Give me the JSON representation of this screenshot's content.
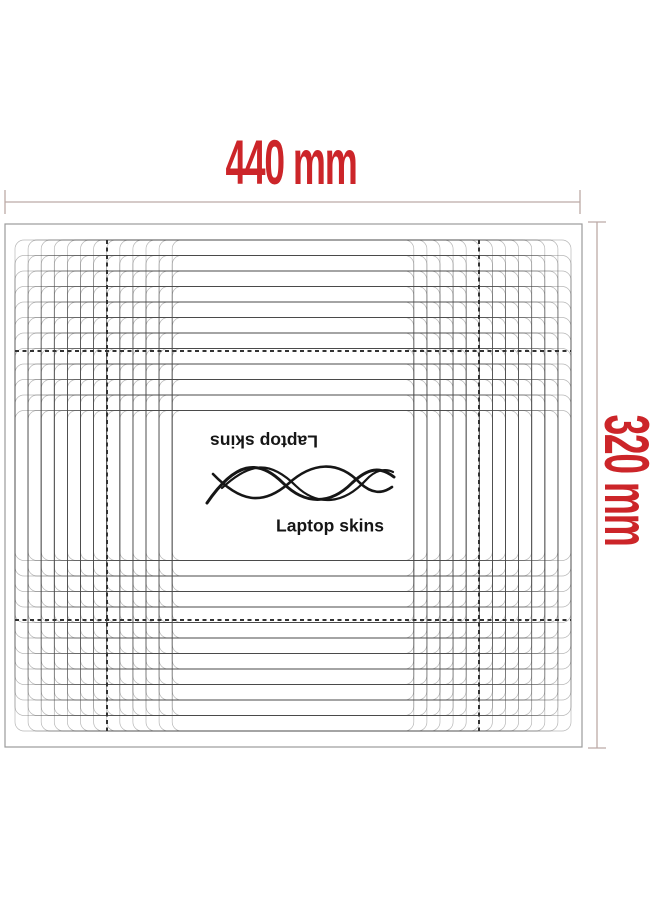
{
  "dimensions": {
    "width_label": "440 mm",
    "height_label": "320 mm"
  },
  "logo": {
    "brand_top_flipped": "Laptop skins",
    "brand_bottom": "Laptop skins"
  },
  "icons": {
    "logo_swirl": "wave-swirl-flourish"
  },
  "colors": {
    "dimension_red": "#cc2529",
    "dim_line": "#bcaaa6",
    "grid_line": "#4a4a4a",
    "dash_line": "#333333",
    "border": "#9b9b9b",
    "logo_ink": "#161616"
  },
  "template": {
    "sheet": {
      "x": 5,
      "y": 224,
      "w": 577,
      "h": 523
    },
    "center": {
      "x": 293,
      "y": 485.5
    },
    "verticals": {
      "start": 15,
      "step": 13.1,
      "count": 13
    },
    "horizontals": {
      "start": 240,
      "step": 15.5,
      "count": 12
    },
    "corner_radius": 9,
    "dashed_verticals": [
      107,
      479
    ],
    "dashed_horizontals": [
      351,
      620
    ],
    "dimension_lines": {
      "horizontal": {
        "y": 202,
        "x1": 5,
        "x2": 580,
        "tick_half": 12
      },
      "vertical": {
        "x": 597,
        "y1": 222,
        "y2": 748,
        "tick_half": 9
      }
    }
  }
}
